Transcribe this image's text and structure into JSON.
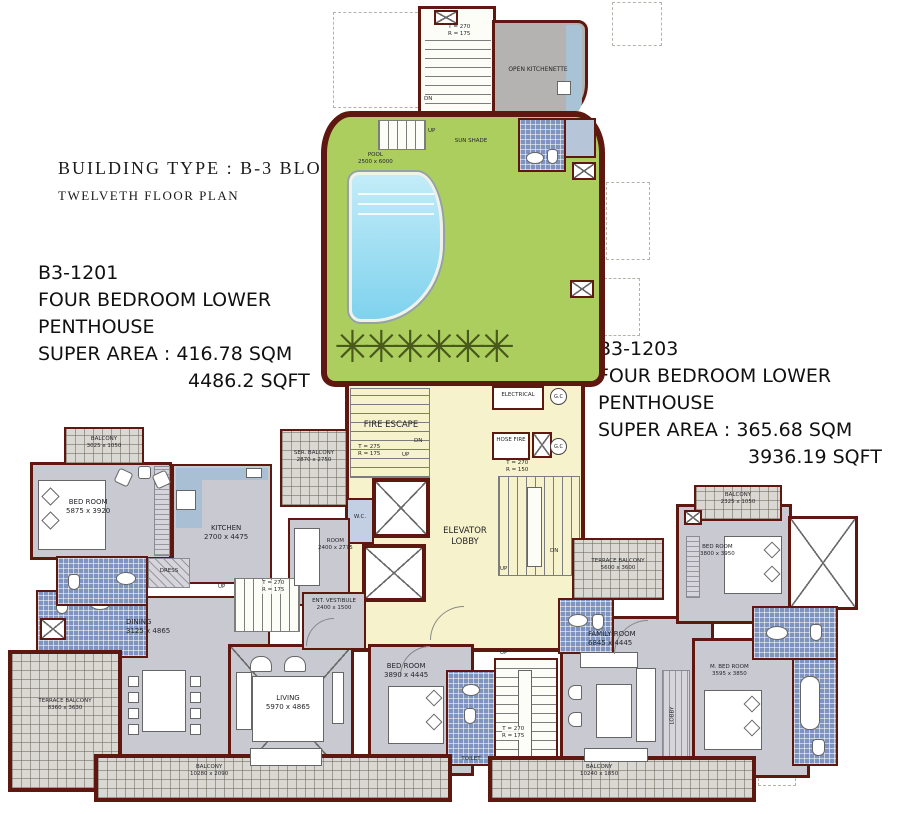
{
  "colors": {
    "wall": "#5e180f",
    "green": "#abce5f",
    "pool": "#7fd2ee",
    "yellow": "#f6f2cb",
    "gray": "#c9c9d2",
    "kgray": "#b4b3b1",
    "tile": "#dad8d2",
    "bath": "#7e93bd",
    "counter": "#a9bfd4"
  },
  "header": {
    "building_type": "BUILDING TYPE : B-3  BLOCK",
    "floor": "TWELVETH  FLOOR PLAN"
  },
  "units": [
    {
      "id": "B3-1201",
      "type_line1": "FOUR BEDROOM LOWER",
      "type_line2": "PENTHOUSE",
      "area_sqm": "SUPER AREA : 416.78 SQM",
      "area_sqft": "4486.2 SQFT"
    },
    {
      "id": "B3-1203",
      "type_line1": "FOUR BEDROOM LOWER",
      "type_line2": "PENTHOUSE",
      "area_sqm": "SUPER AREA : 365.68 SQM",
      "area_sqft": "3936.19 SQFT"
    }
  ],
  "rooms": {
    "open_kitchenette": {
      "name": "OPEN KITCHENETTE",
      "dims": ""
    },
    "pool": {
      "name": "POOL",
      "dims": "2500 x 6000"
    },
    "sun_shade": {
      "name": "SUN SHADE",
      "dims": ""
    },
    "fire_escape": {
      "name": "FIRE ESCAPE",
      "dims": ""
    },
    "electrical": {
      "name": "ELECTRICAL",
      "dims": ""
    },
    "hose_fire": {
      "name": "HOSE FIRE",
      "dims": ""
    },
    "elevator_lobby": {
      "name": "ELEVATOR",
      "dims": "LOBBY"
    },
    "wc": {
      "name": "W.C.",
      "dims": ""
    },
    "balcony_left_top": {
      "name": "BALCONY",
      "dims": "3025 x 1050"
    },
    "bed_room_left": {
      "name": "BED ROOM",
      "dims": "5875 x 3920"
    },
    "kitchen": {
      "name": "KITCHEN",
      "dims": "2700 x 4475"
    },
    "serv_balcony": {
      "name": "SER. BALCONY",
      "dims": "2870 x 2750"
    },
    "maid_room": {
      "name": "ROOM",
      "dims": "2400 x 2775"
    },
    "dress": {
      "name": "DRESS",
      "dims": ""
    },
    "toilet": {
      "name": "TOILET",
      "dims": ""
    },
    "dining": {
      "name": "DINING",
      "dims": "3125 x 4865"
    },
    "terrace_balcony_left": {
      "name": "TERRACE BALCONY",
      "dims": "8360 x 3630"
    },
    "ent_vestibule": {
      "name": "ENT. VESTIBULE",
      "dims": "2400 x 1500"
    },
    "living": {
      "name": "LIVING",
      "dims": "5970 x 4865"
    },
    "bed_room_center": {
      "name": "BED ROOM",
      "dims": "3890 x 4445"
    },
    "balcony_bottom_left": {
      "name": "BALCONY",
      "dims": "10280 x 2090"
    },
    "family_room": {
      "name": "FAMILY  ROOM",
      "dims": "6845 x 4445"
    },
    "lobby": {
      "name": "LOBBY",
      "dims": ""
    },
    "m_bed_room": {
      "name": "M. BED ROOM",
      "dims": "3595 x 3850"
    },
    "bed_room_right": {
      "name": "BED ROOM",
      "dims": "3800 x 3950"
    },
    "balcony_right_top": {
      "name": "BALCONY",
      "dims": "2325 x 1050"
    },
    "terrace_balcony_right": {
      "name": "TERRACE BALCONY",
      "dims": "5600 x 3600"
    },
    "balcony_bottom_right": {
      "name": "BALCONY",
      "dims": "10240 x 1850"
    }
  },
  "stairs": {
    "top": {
      "t": "T = 270",
      "r": "R = 175"
    },
    "fire_escape": {
      "t": "T = 275",
      "r": "R = 175"
    },
    "core_right": {
      "t": "T = 270",
      "r": "R = 150"
    },
    "left": {
      "t": "T = 270",
      "r": "R = 175"
    },
    "bottom": {
      "t": "T = 270",
      "r": "R = 175"
    }
  },
  "markers": {
    "up": "UP",
    "dn": "DN",
    "gc": "G.C"
  },
  "icons": {
    "palm": "✳"
  }
}
